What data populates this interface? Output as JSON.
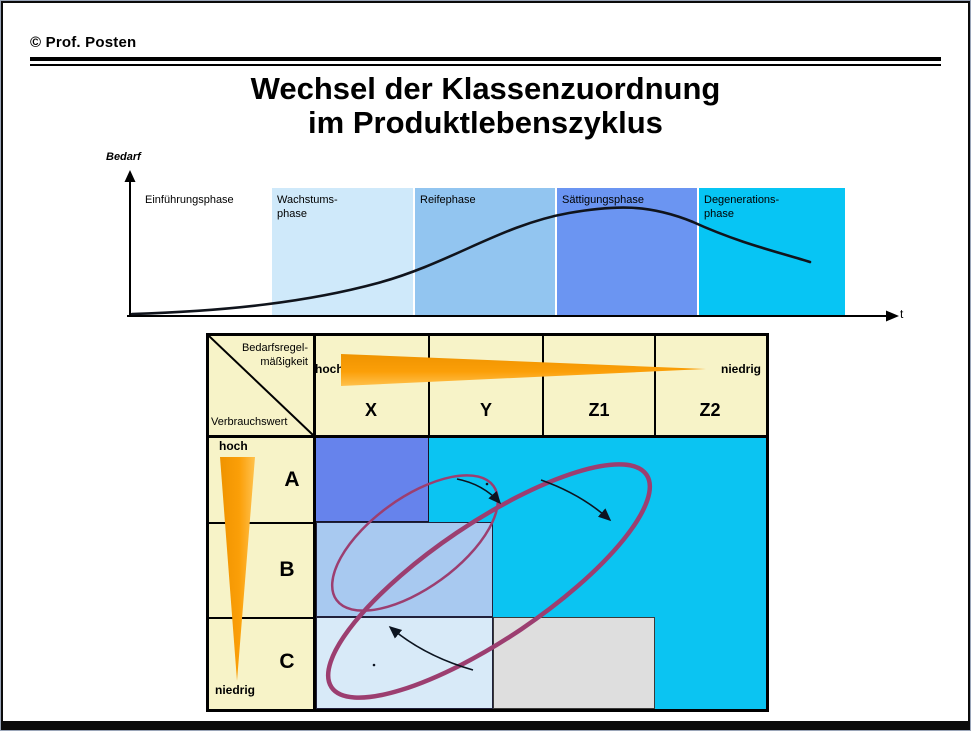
{
  "header": {
    "copyright": "© Prof. Posten"
  },
  "title": {
    "line1": "Wechsel der Klassenzuordnung",
    "line2": "im Produktlebenszyklus"
  },
  "chart": {
    "y_axis_label": "Bedarf",
    "x_axis_label": "t",
    "phases": [
      {
        "label": "Einführungsphase",
        "label2": "",
        "color": "#FFFFFF"
      },
      {
        "label": "Wachstums-",
        "label2": "phase",
        "color": "#CFE9FA"
      },
      {
        "label": "Reifephase",
        "label2": "",
        "color": "#92C5F0"
      },
      {
        "label": "Sättigungsphase",
        "label2": "",
        "color": "#6B95F2"
      },
      {
        "label": "Degenerations-",
        "label2": "phase",
        "color": "#07C5F4"
      }
    ]
  },
  "matrix": {
    "corner": {
      "top_label1": "Bedarfsregel-",
      "top_label2": "mäßigkeit",
      "bottom_label": "Verbrauchswert"
    },
    "col_scale": {
      "high": "hoch",
      "low": "niedrig"
    },
    "row_scale": {
      "high": "hoch",
      "low": "niedrig"
    },
    "columns": [
      "X",
      "Y",
      "Z1",
      "Z2"
    ],
    "rows": [
      "A",
      "B",
      "C"
    ]
  },
  "colors": {
    "matrix_header_cream": "#F7F3C8",
    "body_cyan": "#0BC4F2",
    "cell_ax_blue": "#6683EC",
    "row_b_rect_blue": "#A8C9F0",
    "row_c_rect_pale": "#D8EAF8",
    "row_c_rect_gray": "#DEDEDE",
    "wedge_orange": "#F89E07",
    "shift_ellipse_plum": "#9C3E70",
    "curve_black": "#10141c"
  }
}
